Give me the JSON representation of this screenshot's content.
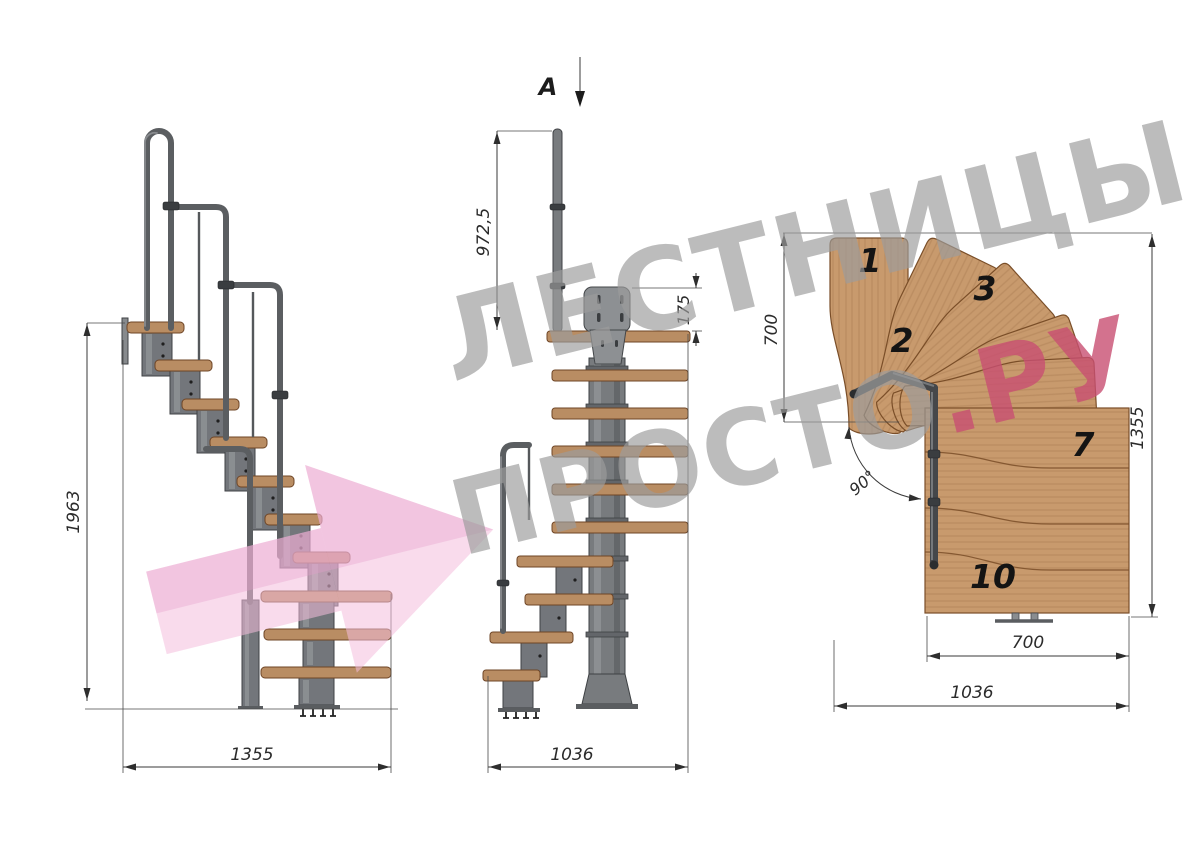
{
  "watermark": {
    "line1": "ЛЕСТНИЦЫ",
    "line2": "ПРОСТО",
    "line2_accent": ".РУ"
  },
  "side_view": {
    "height_dim": "1963",
    "width_dim": "1355"
  },
  "front_view": {
    "section_label": "A",
    "handrail_dim": "972,5",
    "plate_dim": "175",
    "width_dim": "1036"
  },
  "plan_view": {
    "left_dim": "700",
    "right_dim": "1355",
    "inner_width_dim": "700",
    "outer_width_dim": "1036",
    "angle_dim": "90°",
    "treads": [
      "1",
      "2",
      "3",
      "7",
      "10"
    ]
  },
  "colors": {
    "wood": "#c89a6d",
    "wood_edge": "#7a4e28",
    "metal": "#73767b",
    "metal_dark": "#3f4245",
    "dimension_line": "#3a3a3a",
    "watermark_gray": "#9c9c9c",
    "watermark_pink": "#f4bddd",
    "accent": "#c84f72"
  }
}
